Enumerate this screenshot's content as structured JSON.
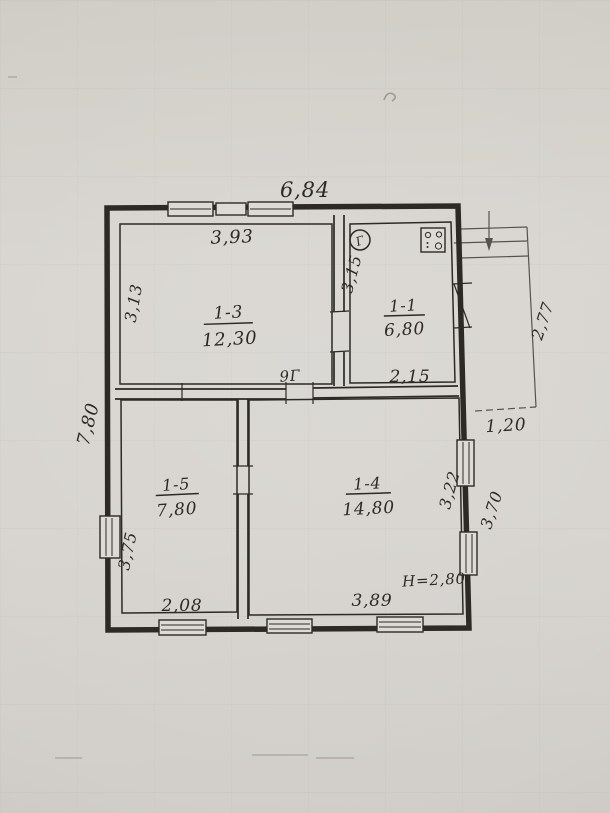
{
  "colors": {
    "paper": "#d6d3cc",
    "ink": "#2d2a25",
    "ink_light": "#57524b"
  },
  "overall": {
    "width_total": "6,84",
    "depth_total": "7,80"
  },
  "rooms": [
    {
      "number": "1-3",
      "area": "12,30",
      "dim_top": "3,93",
      "dim_left": "3,13",
      "note": "9Г"
    },
    {
      "number": "1-1",
      "area": "6,80",
      "dim_left": "3,15",
      "dim_bottom": "2,15"
    },
    {
      "number": "1-5",
      "area": "7,80",
      "dim_left": "3,75",
      "dim_bottom": "2,08"
    },
    {
      "number": "1-4",
      "area": "14,80",
      "dim_right": "3,22",
      "dim_bottom": "3,89",
      "height_note": "Н=2,80"
    }
  ],
  "porch": {
    "dim_height": "2,77",
    "dim_width": "1,20",
    "dim_wall": "3,70"
  },
  "symbols": {
    "gas_meter_letter": "Г"
  },
  "icons": {
    "gas_meter": "circle with letter Г",
    "gas_stove": "square with four burner marks",
    "entrance_arrow": "downward arrow at porch steps"
  }
}
